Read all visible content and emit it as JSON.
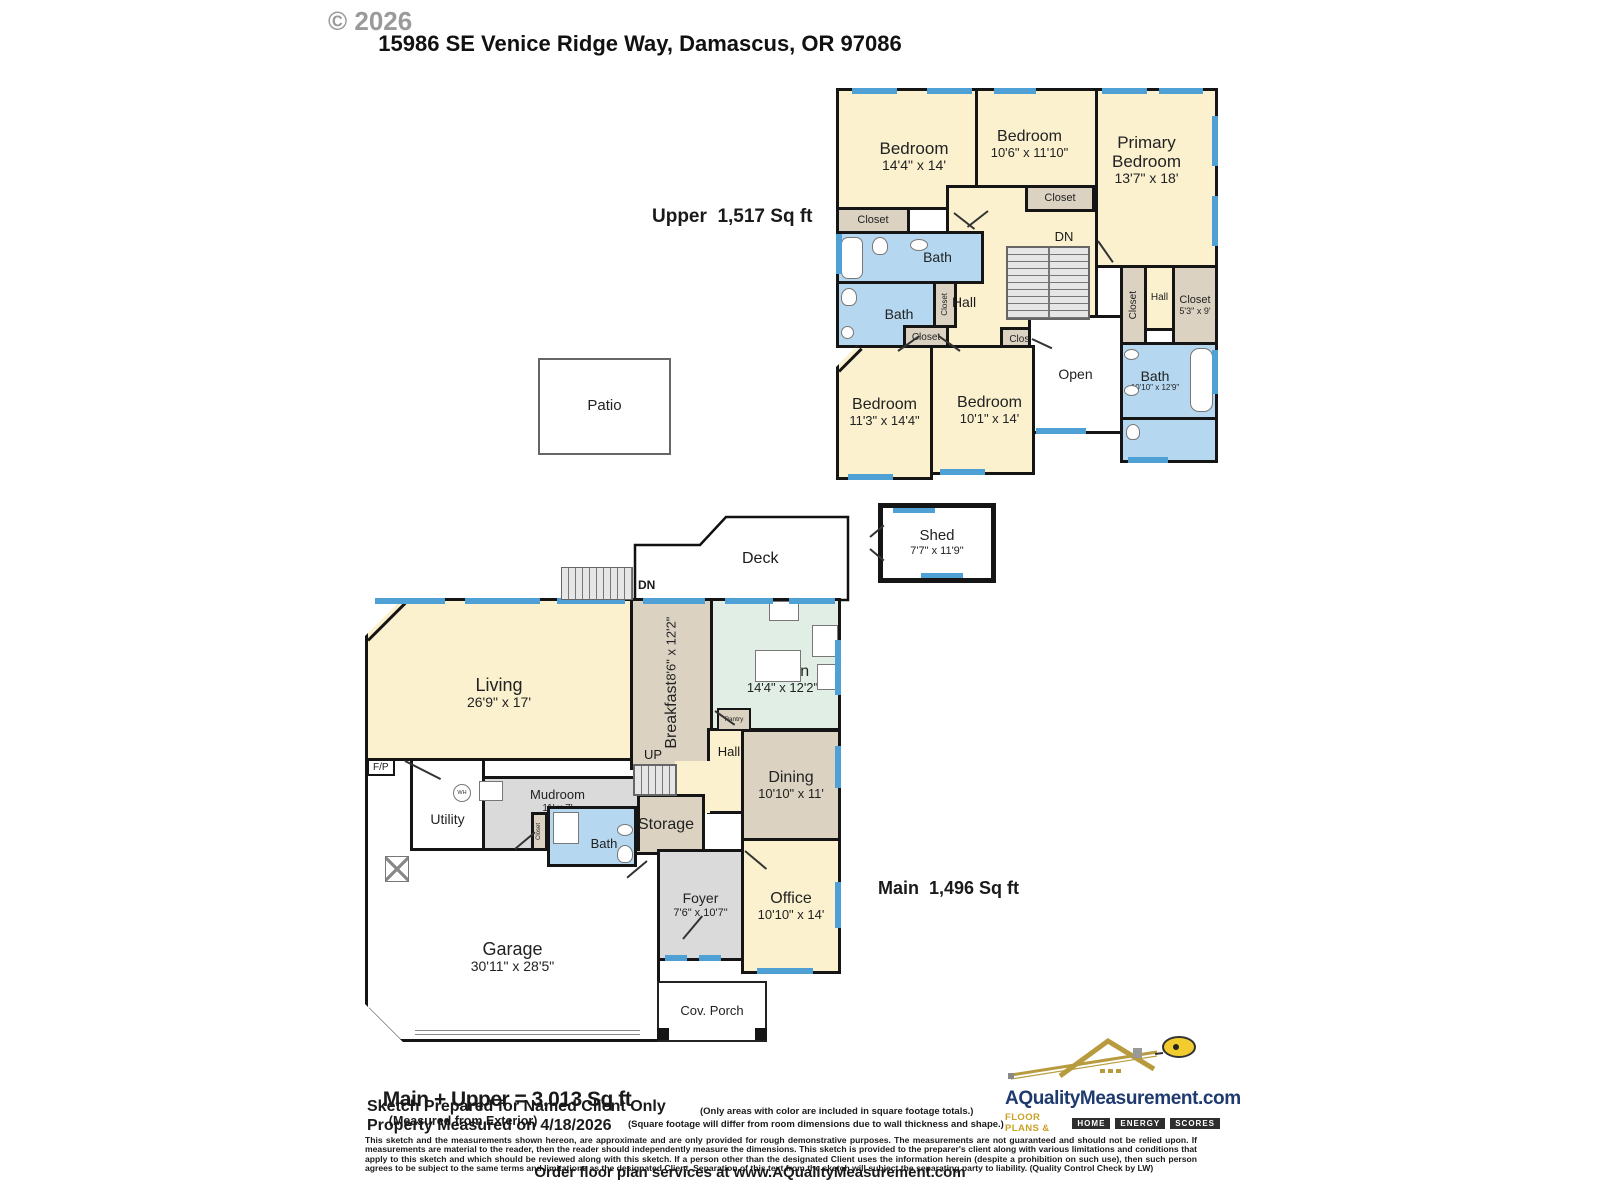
{
  "header": {
    "copyright": "© 2026",
    "address": "15986 SE Venice Ridge Way, Damascus, OR 97086"
  },
  "upper": {
    "label": "Upper  1,517 Sq ft",
    "bedroom_a": {
      "name": "Bedroom",
      "dims": "14'4\" x 14'"
    },
    "bedroom_b": {
      "name": "Bedroom",
      "dims": "10'6\" x 11'10\""
    },
    "primary": {
      "name": "Primary Bedroom",
      "dims": "13'7\" x 18'"
    },
    "bedroom_c": {
      "name": "Bedroom",
      "dims": "11'3\" x 14'4\""
    },
    "bedroom_d": {
      "name": "Bedroom",
      "dims": "10'1\" x 14'"
    },
    "bath_top": "Bath",
    "bath_left": "Bath",
    "bath_right": {
      "name": "Bath",
      "dims": "10'10\" x 12'9\""
    },
    "closet": "Closet",
    "closet_sized": {
      "name": "Closet",
      "dims": "5'3\" x 9'"
    },
    "hall": "Hall",
    "hall2": "Hall",
    "open": "Open",
    "dn": "DN"
  },
  "main": {
    "label": "Main  1,496 Sq ft",
    "living": {
      "name": "Living",
      "dims": "26'9\" x 17'"
    },
    "breakfast": {
      "name": "Breakfast",
      "dims": "8'6\" x 12'2\""
    },
    "kitchen": {
      "name": "Kitchen",
      "dims": "14'4\" x 12'2\""
    },
    "pantry": "Pantry",
    "hall": "Hall",
    "up": "UP",
    "storage": "Storage",
    "dining": {
      "name": "Dining",
      "dims": "10'10\" x 11'"
    },
    "office": {
      "name": "Office",
      "dims": "10'10\" x 14'"
    },
    "foyer": {
      "name": "Foyer",
      "dims": "7'6\" x 10'7\""
    },
    "mudroom": {
      "name": "Mudroom",
      "dims": "11' x 7'"
    },
    "utility": "Utility",
    "bath": "Bath",
    "closet": "Closet",
    "garage": {
      "name": "Garage",
      "dims": "30'11\" x 28'5\""
    },
    "cov_porch": "Cov. Porch",
    "fp": "F/P",
    "wh": "WH"
  },
  "outdoor": {
    "patio": "Patio",
    "deck": "Deck",
    "deck_dn": "DN",
    "shed": {
      "name": "Shed",
      "dims": "7'7\" x 11'9\""
    }
  },
  "footer": {
    "total": "Main + Upper = 3,013 Sq ft",
    "total_note": "(Measured from Exterior)",
    "prepared": "Sketch Prepared for Named Client Only",
    "measured": "Property Measured on 4/18/2026",
    "note1": "(Only areas with color are included in square footage totals.)",
    "note2": "(Square footage will differ from room dimensions due to wall thickness and shape.)",
    "disclaimer": "This sketch and the measurements shown hereon, are approximate and are only provided for rough demonstrative purposes.  The measurements are not guaranteed and should not be relied upon.  If measurements are material to the reader, then the reader should independently measure the dimensions.  This sketch is provided to the preparer's client along with various limitations and conditions that apply to this sketch and which should be reviewed along with this sketch.  If a person other than the designated Client uses the information herein (despite a prohibition on such use), then such person agrees to be subject to the same terms and limitations as the designated Client.  Separation of this text from the sketch will subject the separating party to liability.  (Quality Control Check by LW)",
    "order": "Order floor plan services at www.AQualityMeasurement.com"
  },
  "logo": {
    "domain": "AQualityMeasurement.com",
    "tagline": "FLOOR PLANS &",
    "badges": [
      "HOME",
      "ENERGY",
      "SCORES"
    ]
  },
  "colors": {
    "room_cream": "#FBF1CF",
    "room_tan": "#DBD2C2",
    "room_bath_blue": "#B5D8F0",
    "room_kitchen_mint": "#E0EEE5",
    "room_gray": "#DADADA",
    "window_blue": "#4FA0D5",
    "wall_black": "#151515",
    "logo_navy": "#1E3A6E",
    "logo_gold": "#C9A227"
  }
}
